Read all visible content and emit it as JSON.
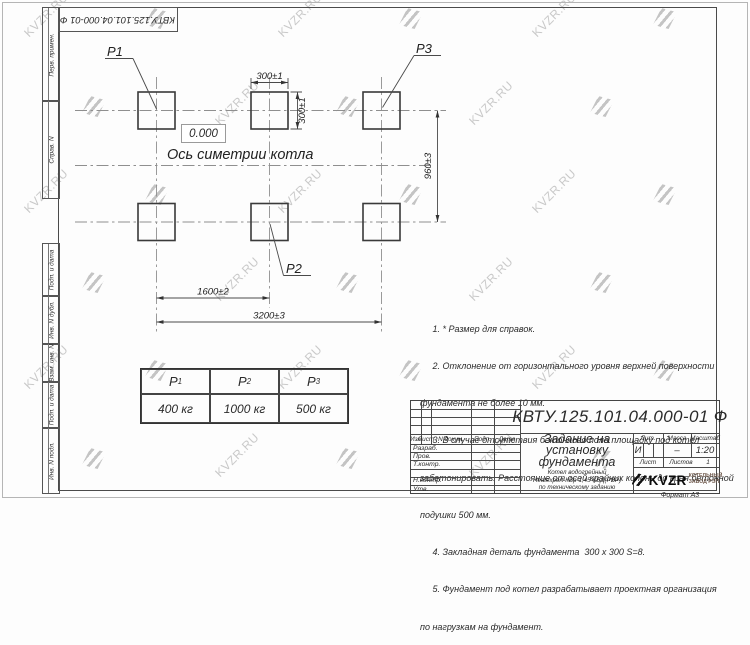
{
  "watermark": {
    "text": "KVZR.RU"
  },
  "corner_stamp": "КВТУ.125.101.04.000-01 Ф",
  "sidebar": {
    "labels": [
      "Перв. примен.",
      "Справ. N",
      "Подп. и дата",
      "Инв. N дубл.",
      "Взам. инв. N",
      "Подп. и дата",
      "Инв. N подл."
    ]
  },
  "drawing": {
    "labels": {
      "p1": "P1",
      "p2": "P2",
      "p3": "P3"
    },
    "level_mark": "0.000",
    "axis_caption": "Ось симетрии котла",
    "dimensions": {
      "width_top": "300±1",
      "height_right": "300±1",
      "row_spacing": "960±3",
      "col_spacing_mid": "1600±2",
      "col_spacing_total": "3200±3"
    }
  },
  "notes": {
    "lines": [
      "     1. * Размер для справок.",
      "     2. Отклонение от горизонтального уровня верхней поверхности",
      "фундамента не более 10 мм.",
      "     3. В случае отсутствия бетонного пола площадку под котел",
      "забетонировать. Расстояние от осей крайних колонн до края бетонной",
      "подушки 500 мм.",
      "     4. Закладная деталь фундамента  300 x 300 S=8.",
      "     5. Фундамент под котел разрабатывает проектная организация",
      "по нагрузкам на фундамент."
    ]
  },
  "load_table": {
    "columns": [
      {
        "symbol": "Р",
        "index": "1"
      },
      {
        "symbol": "Р",
        "index": "2"
      },
      {
        "symbol": "Р",
        "index": "3"
      }
    ],
    "values": [
      "400 кг",
      "1000 кг",
      "500 кг"
    ]
  },
  "title_block": {
    "designation": "КВТУ.125.101.04.000-01 Ф",
    "doc_title_lines": [
      "Задание на",
      "установку",
      "фундамента"
    ],
    "subtitle_lines": [
      "Котел водогрейный",
      "Heatexpert-КВр-1,45-КБД(РВР)",
      "по техническому заданию"
    ],
    "header_cells": [
      "Изм",
      "Лист",
      "N докум.",
      "Подп.",
      "Дата"
    ],
    "row_labels": [
      "Разраб.",
      "Пров.",
      "Т.контр.",
      "Н.контр.",
      "Утв."
    ],
    "lit_header": "Лит.",
    "mass_header": "Масса",
    "scale_header": "Масштаб",
    "lit_value": "И",
    "mass_value": "–",
    "scale_value": "1:20",
    "sheet_label": "Лист",
    "sheets_label": "Листов",
    "sheets_value": "1",
    "logo_text": "KVZR",
    "logo_caption_lines": [
      "КОТЕЛЬНЫЙ",
      "ЗАВОД РЭП"
    ],
    "format_label": "Формат А3"
  }
}
